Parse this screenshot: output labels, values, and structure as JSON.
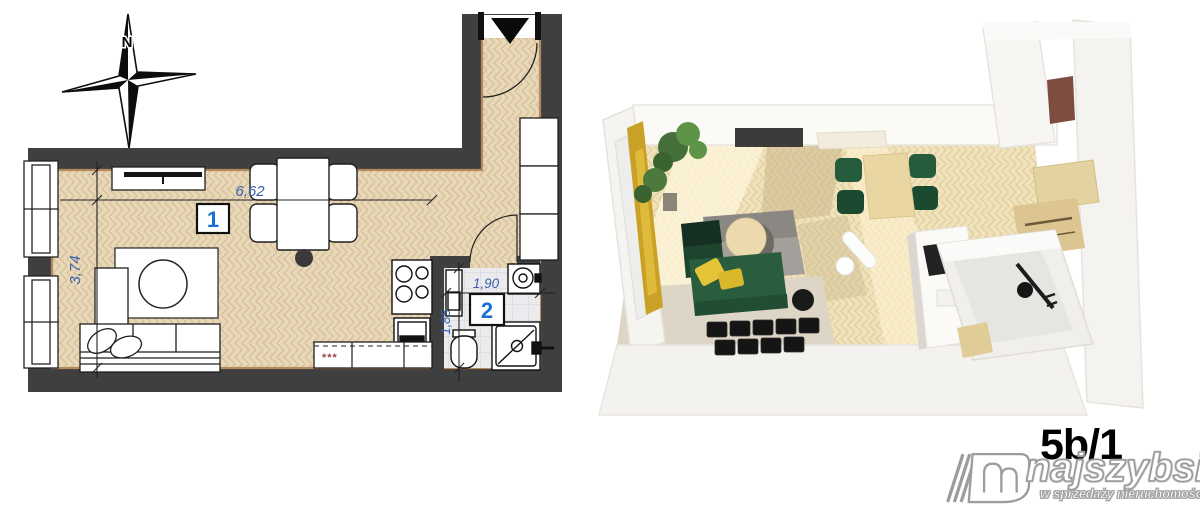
{
  "floor_plan": {
    "compass_label": "N",
    "room1": {
      "number": "1",
      "width_label": "6,62",
      "depth_label": "3,74"
    },
    "room2": {
      "number": "2",
      "width_label": "1,90",
      "depth_label": "1,85"
    },
    "kitchen_hob_marker": "***",
    "colors": {
      "wall_dark": "#3f3f3f",
      "floor_tan": "#e8d8b8",
      "bath_tile": "#ebebee",
      "dimension_blue": "#3a5fae",
      "room_number_blue": "#1a6fd4"
    }
  },
  "render_3d": {
    "colors": {
      "sofa_green": "#2a5c3e",
      "chair_green": "#245c3d",
      "accent_yellow": "#c9a127",
      "floor_tan": "#f0e2ba"
    }
  },
  "branding": {
    "unit_label": "5b/1",
    "brand_name": "najszybsi",
    "brand_tagline": "w sprzedaży nieruchomości"
  }
}
